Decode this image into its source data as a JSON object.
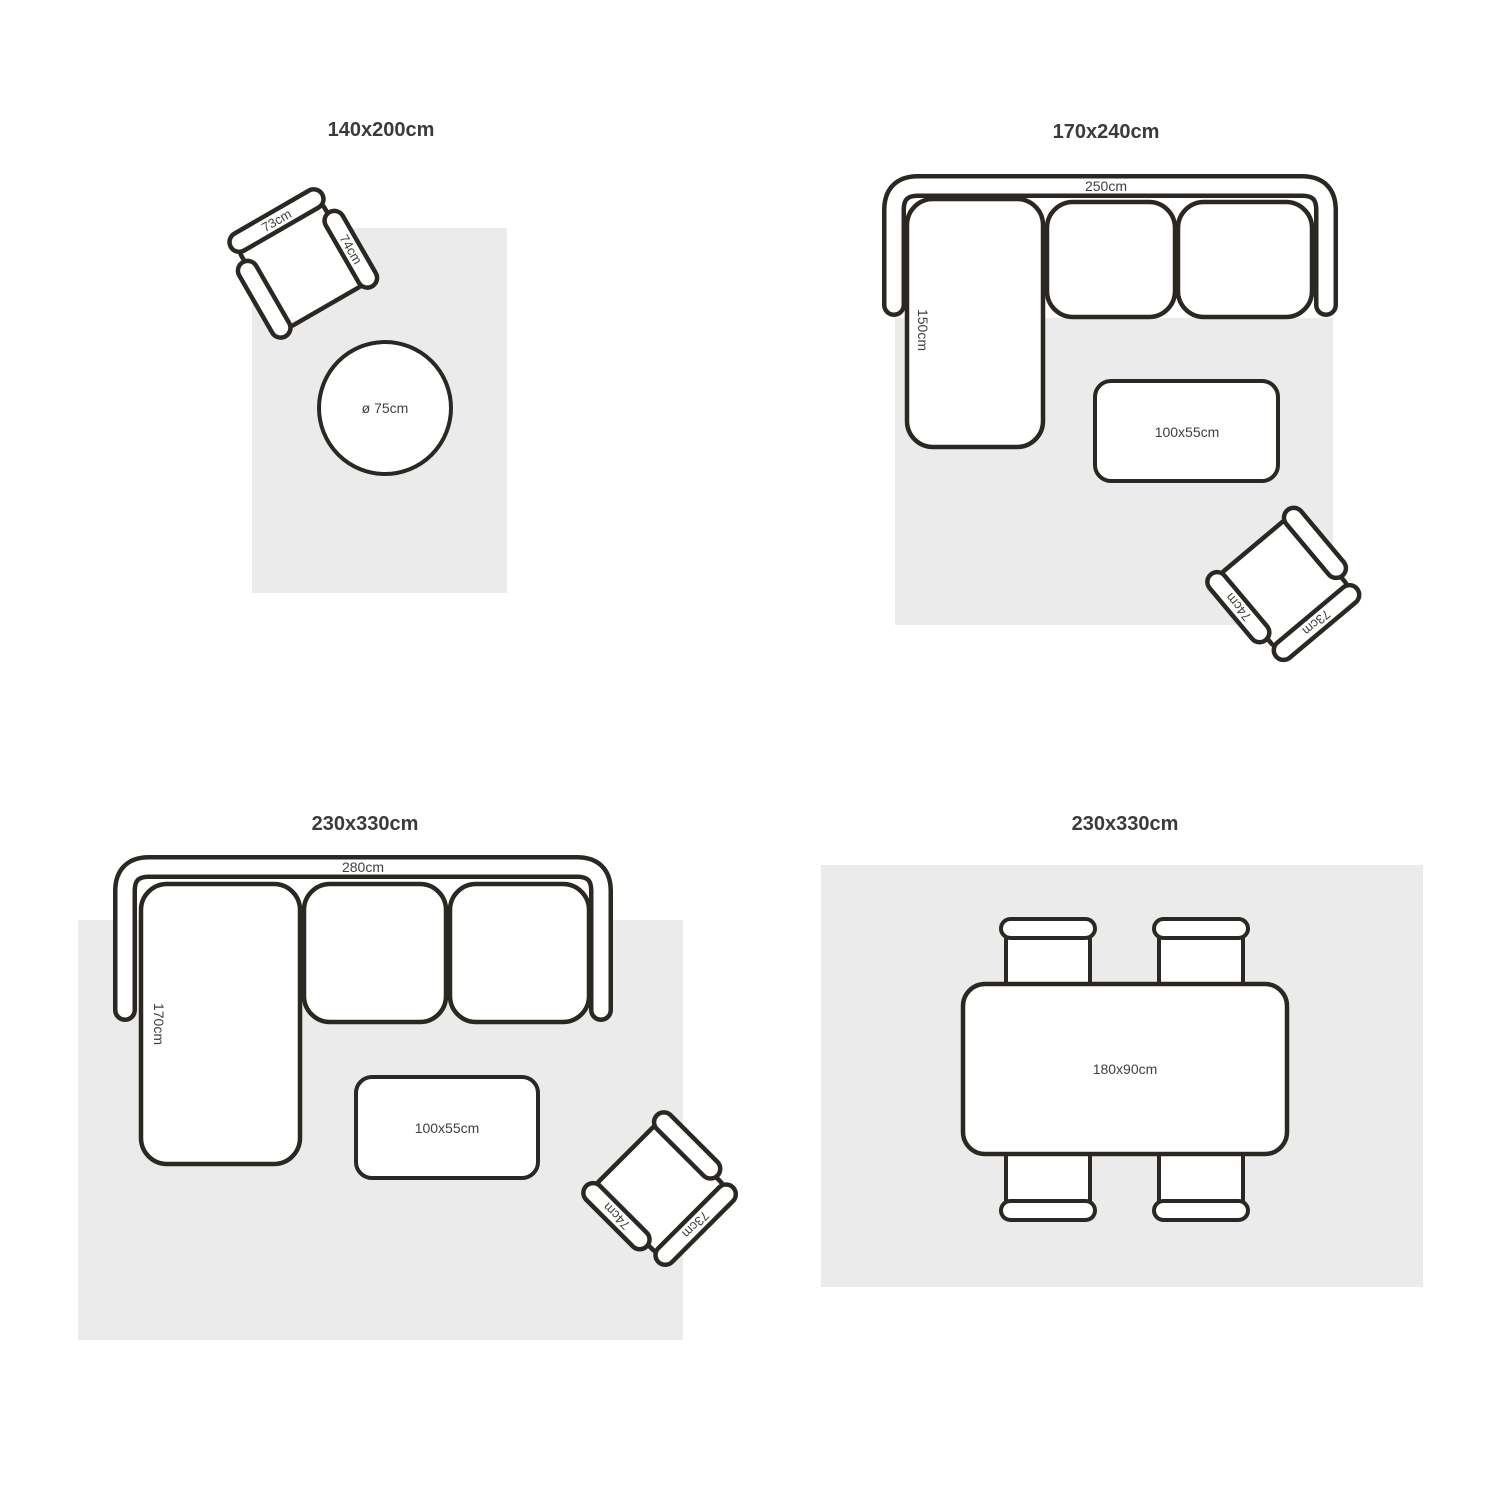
{
  "figure": "rug-size-guide",
  "colors": {
    "background": "#ffffff",
    "rug": "#ebebeb",
    "outline": "#2b2823",
    "label_text": "#3f3f3f",
    "title_text": "#3b3b3b"
  },
  "q1": {
    "title": "140x200cm",
    "armchair_back_label": "73cm",
    "armchair_arm_label": "74cm",
    "side_table_label": "ø 75cm"
  },
  "q2": {
    "title": "170x240cm",
    "sofa_width_label": "250cm",
    "sofa_chaise_label": "150cm",
    "coffee_table_label": "100x55cm",
    "armchair_back_label": "73cm",
    "armchair_arm_label": "74cm"
  },
  "q3": {
    "title": "230x330cm",
    "sofa_width_label": "280cm",
    "sofa_chaise_label": "170cm",
    "coffee_table_label": "100x55cm",
    "armchair_back_label": "73cm",
    "armchair_arm_label": "74cm"
  },
  "q4": {
    "title": "230x330cm",
    "dining_table_label": "180x90cm"
  }
}
